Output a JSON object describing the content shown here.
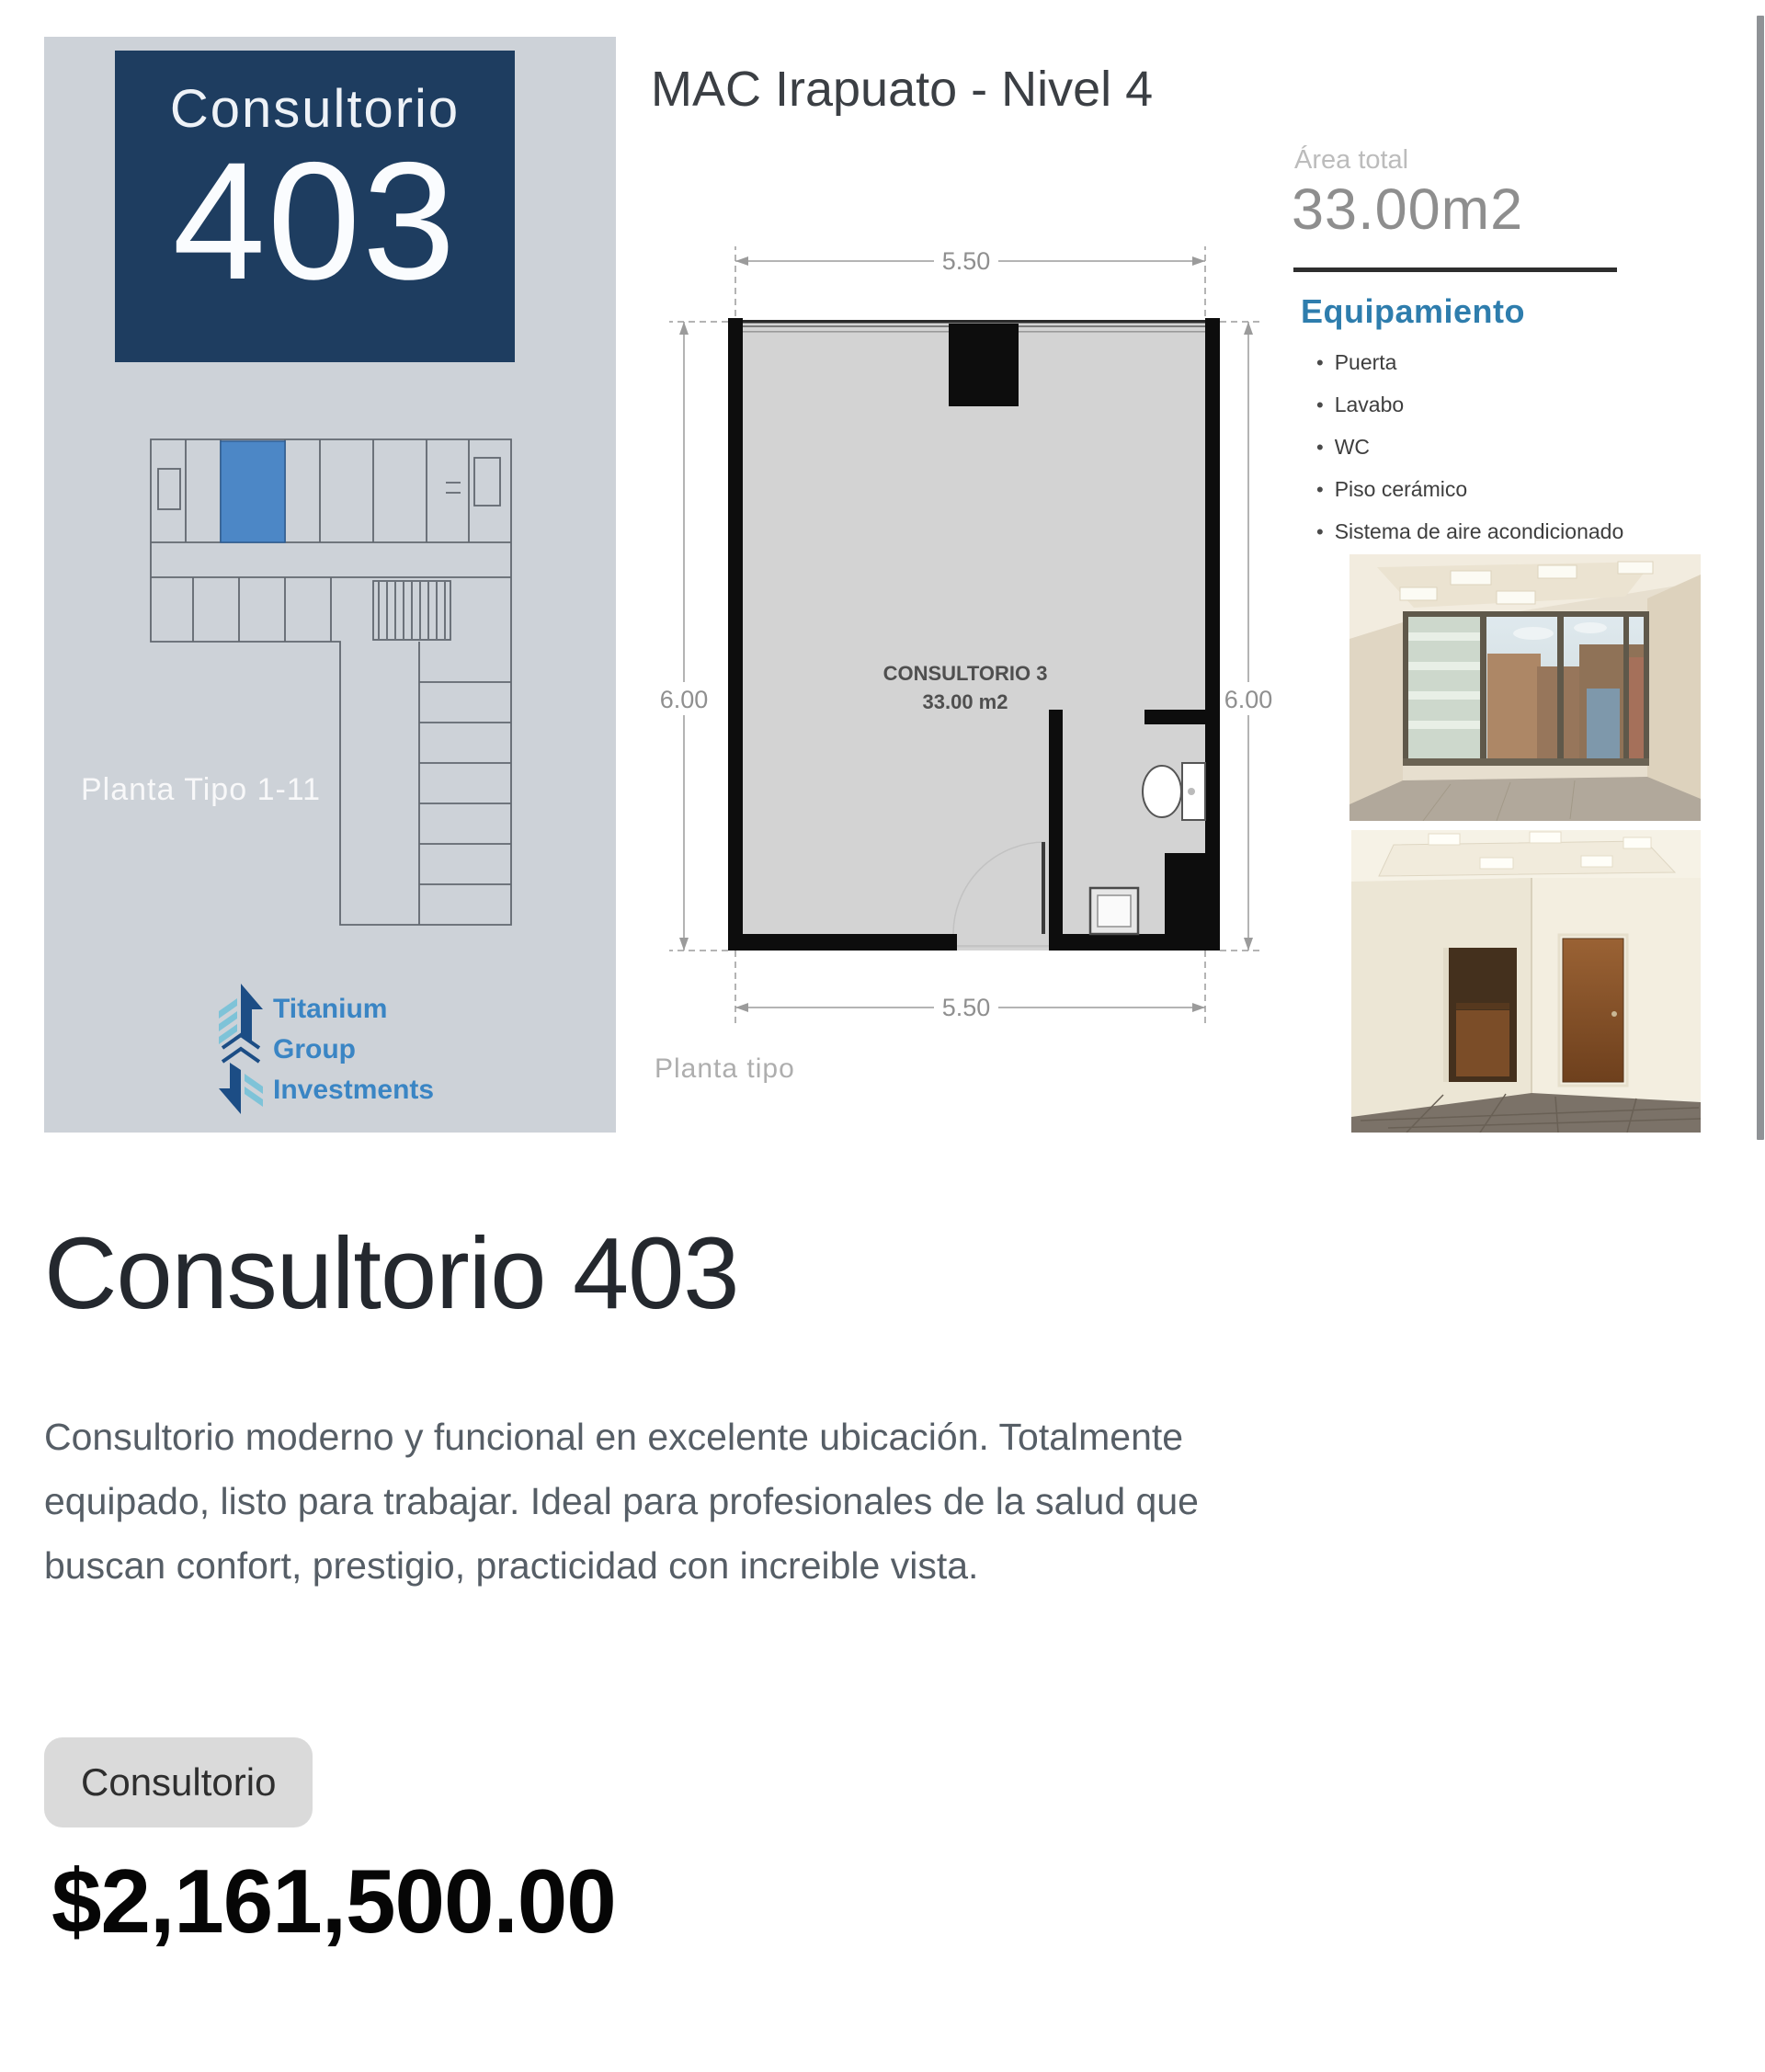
{
  "flyer": {
    "left_panel": {
      "unit_label": "Consultorio",
      "unit_number": "403",
      "floor_caption": "Planta Tipo 1-11",
      "logo": {
        "line1": "Titanium",
        "line2": "Group",
        "line3": "Investments"
      }
    },
    "title": "MAC Irapuato - Nivel 4",
    "floorplan": {
      "dim_top": "5.50",
      "dim_bottom": "5.50",
      "dim_left": "6.00",
      "dim_right": "6.00",
      "room_name": "CONSULTORIO 3",
      "room_area": "33.00 m2",
      "caption": "Planta tipo"
    },
    "area_total": {
      "label": "Área total",
      "value": "33.00m2"
    },
    "equipment": {
      "title": "Equipamiento",
      "items": [
        "Puerta",
        "Lavabo",
        "WC",
        "Piso cerámico",
        "Sistema de aire acondicionado"
      ]
    }
  },
  "listing": {
    "title": "Consultorio 403",
    "description": "Consultorio moderno y funcional en excelente ubicación. Totalmente equipado, listo para trabajar. Ideal para profesionales de la salud que buscan confort, prestigio, practicidad con increible vista.",
    "description_lines": [
      "Consultorio moderno y funcional en excelente ubicación. Totalmente",
      "equipado, listo para trabajar. Ideal para profesionales de la salud que",
      "buscan confort, prestigio, practicidad con increible vista."
    ],
    "category": "Consultorio",
    "price": "$2,161,500.00"
  },
  "colors": {
    "brand_navy": "#1e3d60",
    "equipment_blue": "#2e7dad",
    "logo_blue": "#3a85c4",
    "highlight_room_blue": "#4c87c6",
    "panel_gray": "#cdd2d8"
  }
}
